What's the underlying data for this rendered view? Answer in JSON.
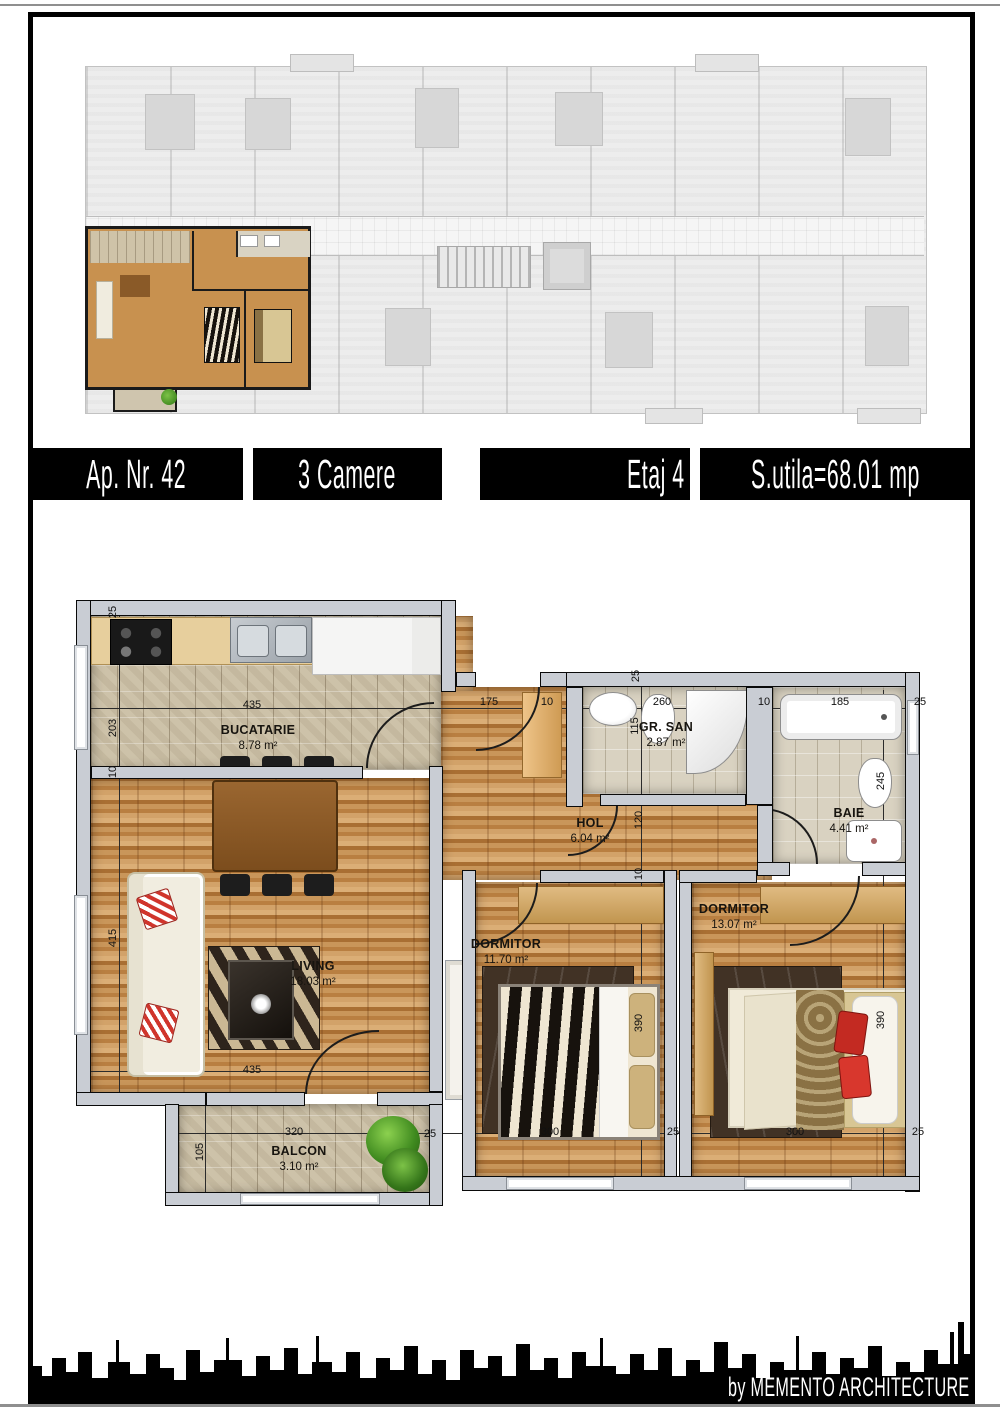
{
  "header": {
    "items": [
      {
        "label": "Ap. Nr. 42"
      },
      {
        "label": "3 Camere"
      },
      {
        "label": "Etaj 4"
      },
      {
        "label": "S.utila=68.01 mp"
      }
    ]
  },
  "footer": {
    "credit": "by MEMENTO ARCHITECTURE"
  },
  "colors": {
    "highlight_wood": "#c08b4c",
    "tile": "#cdc2a9",
    "wall": "#c9cdd4",
    "black": "#000000"
  },
  "floor_plan": {
    "rooms": [
      {
        "id": "bucatarie",
        "name": "BUCATARIE",
        "area": "8.78 m²",
        "x": 258,
        "y": 738
      },
      {
        "id": "hol",
        "name": "HOL",
        "area": "6.04 m²",
        "x": 590,
        "y": 831
      },
      {
        "id": "gr-san",
        "name": "GR. SAN",
        "area": "2.87 m²",
        "x": 666,
        "y": 735
      },
      {
        "id": "baie",
        "name": "BAIE",
        "area": "4.41 m²",
        "x": 849,
        "y": 821
      },
      {
        "id": "living",
        "name": "LIVING",
        "area": "18.03 m²",
        "x": 313,
        "y": 974
      },
      {
        "id": "dormitor-1",
        "name": "DORMITOR",
        "area": "11.70 m²",
        "x": 506,
        "y": 952
      },
      {
        "id": "dormitor-2",
        "name": "DORMITOR",
        "area": "13.07 m²",
        "x": 734,
        "y": 917
      },
      {
        "id": "balcon",
        "name": "BALCON",
        "area": "3.10 m²",
        "x": 299,
        "y": 1159
      }
    ],
    "dimension_labels": [
      {
        "t": "25",
        "x": 113,
        "y": 612,
        "v": true
      },
      {
        "t": "203",
        "x": 113,
        "y": 728,
        "v": true
      },
      {
        "t": "10",
        "x": 113,
        "y": 772,
        "v": true
      },
      {
        "t": "435",
        "x": 252,
        "y": 705
      },
      {
        "t": "175",
        "x": 489,
        "y": 702
      },
      {
        "t": "10",
        "x": 547,
        "y": 702
      },
      {
        "t": "25",
        "x": 636,
        "y": 676,
        "v": true
      },
      {
        "t": "260",
        "x": 662,
        "y": 702
      },
      {
        "t": "115",
        "x": 635,
        "y": 726,
        "v": true
      },
      {
        "t": "10",
        "x": 764,
        "y": 702
      },
      {
        "t": "185",
        "x": 840,
        "y": 702
      },
      {
        "t": "25",
        "x": 920,
        "y": 702
      },
      {
        "t": "245",
        "x": 881,
        "y": 781,
        "v": true
      },
      {
        "t": "120",
        "x": 639,
        "y": 820,
        "v": true
      },
      {
        "t": "10",
        "x": 639,
        "y": 874,
        "v": true
      },
      {
        "t": "415",
        "x": 113,
        "y": 938,
        "v": true
      },
      {
        "t": "435",
        "x": 252,
        "y": 1070
      },
      {
        "t": "390",
        "x": 639,
        "y": 1023,
        "v": true
      },
      {
        "t": "390",
        "x": 881,
        "y": 1020,
        "v": true
      },
      {
        "t": "320",
        "x": 294,
        "y": 1132
      },
      {
        "t": "105",
        "x": 200,
        "y": 1152,
        "v": true
      },
      {
        "t": "25",
        "x": 430,
        "y": 1134
      },
      {
        "t": "300",
        "x": 550,
        "y": 1132
      },
      {
        "t": "25",
        "x": 673,
        "y": 1132
      },
      {
        "t": "300",
        "x": 795,
        "y": 1132
      },
      {
        "t": "25",
        "x": 918,
        "y": 1132
      }
    ]
  }
}
